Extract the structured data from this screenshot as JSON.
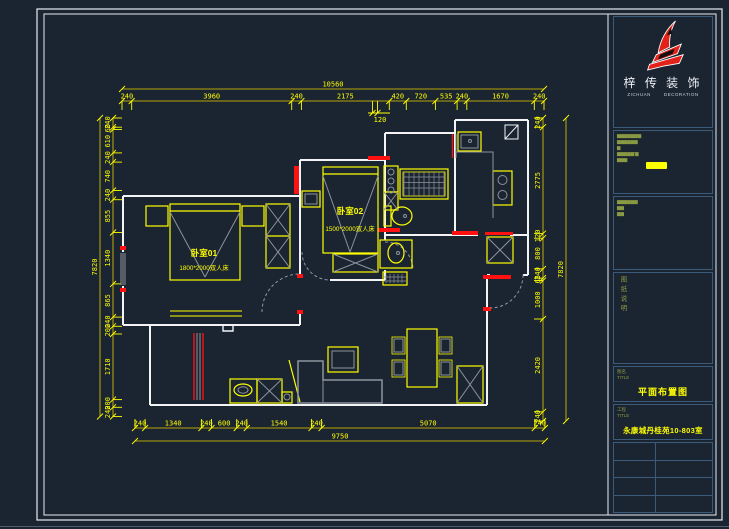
{
  "sheet": {
    "bg": "#1b2431",
    "frame": "#e9edf2",
    "dim_color": "#ffff00",
    "wall_color": "#ffffff",
    "accent_color": "#ff1111"
  },
  "brand": {
    "cn": "梓 传 装 饰",
    "en_left": "ZICHUAN",
    "en_right": "DECORATION"
  },
  "titleblock": {
    "info1": [
      "▆▆▆▆▆▆▆",
      "▆▆▆▆▆▆",
      "▆",
      "▆▆▆▆▆'▆",
      "▆▆▆"
    ],
    "info2": [
      "▆▆▆▆▆▆",
      "▆▆",
      "▆▆"
    ],
    "notes_vertical": "图纸说明",
    "drawn_label_cn": "图名",
    "drawn_label_en": "TITLE",
    "drawn_value": "平面布置图",
    "job_label_cn": "工程",
    "job_label_en": "TITLE",
    "job_value": "永康城丹桂苑10-803室"
  },
  "plan": {
    "rooms": {
      "bedroom1": {
        "name": "卧室01",
        "bed": "1800*2000双人床"
      },
      "bedroom2": {
        "name": "卧室02",
        "bed": "1500*2000双人床"
      }
    },
    "dims": {
      "top_overall": "10560",
      "top": [
        "240",
        "3960",
        "240",
        "2175",
        "420",
        "720",
        "535",
        "240",
        "1670",
        "240"
      ],
      "top_sub": "120",
      "bottom_overall": "9750",
      "bottom": [
        "240",
        "1340",
        "240",
        "600",
        "240",
        "1540",
        "240",
        "5070",
        "240"
      ],
      "left_overall": "7820",
      "left": [
        "240",
        "60",
        "610",
        "240",
        "740",
        "240",
        "855",
        "1340",
        "865",
        "240",
        "200",
        "1710",
        "200",
        "240"
      ],
      "right_overall": "7820",
      "right": [
        "240",
        "2775",
        "120",
        "800",
        "240",
        "65",
        "1000",
        "2420",
        "240"
      ]
    }
  }
}
